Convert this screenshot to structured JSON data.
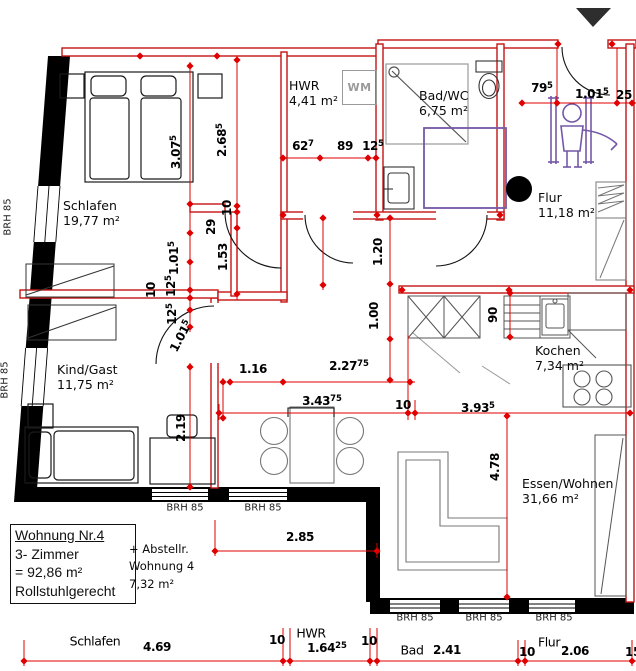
{
  "title_block": {
    "line1": "Wohnung Nr.4",
    "line2": "3- Zimmer",
    "line3": "= 92,86 m²",
    "line4": "Rollstuhlgerecht"
  },
  "annex": {
    "line1": "+ Abstellr.",
    "line2": "Wohnung 4",
    "line3": "7,32 m²"
  },
  "rooms": {
    "schlafen": {
      "name": "Schlafen",
      "area": "19,77 m²"
    },
    "hwr": {
      "name": "HWR",
      "area": "4,41 m²"
    },
    "bad": {
      "name": "Bad/WC",
      "area": "6,75 m²"
    },
    "flur": {
      "name": "Flur",
      "area": "11,18 m²"
    },
    "kind": {
      "name": "Kind/Gast",
      "area": "11,75 m²"
    },
    "kochen": {
      "name": "Kochen",
      "area": "7,34 m²"
    },
    "essen": {
      "name": "Essen/Wohnen",
      "area": "31,66 m²"
    }
  },
  "labels": {
    "wm": "WM",
    "window": "BRH 85"
  },
  "bottom_labels": {
    "schlafen": "Schlafen",
    "hwr": "HWR",
    "bad": "Bad",
    "flur": "Flur"
  },
  "dims": {
    "d307": {
      "main": "3.07",
      "sup": "5"
    },
    "d268": {
      "main": "2.68",
      "sup": "5"
    },
    "d627": {
      "main": "62",
      "sup": "7"
    },
    "d89": {
      "main": "89"
    },
    "d125": {
      "main": "12",
      "sup": "5"
    },
    "d795": {
      "main": "79",
      "sup": "5"
    },
    "d1015": {
      "main": "1.01",
      "sup": "5"
    },
    "d25": {
      "main": "25"
    },
    "d10": {
      "main": "10"
    },
    "d29": {
      "main": "29"
    },
    "d153": {
      "main": "1.53"
    },
    "d120": {
      "main": "1.20"
    },
    "d100": {
      "main": "1.00"
    },
    "d90": {
      "main": "90"
    },
    "d116": {
      "main": "1.16"
    },
    "d2275": {
      "main": "2.27",
      "sup": "75"
    },
    "d34375": {
      "main": "3.43",
      "sup": "75"
    },
    "d3935": {
      "main": "3.93",
      "sup": "5"
    },
    "d478": {
      "main": "4.78"
    },
    "d219": {
      "main": "2.19"
    },
    "d285": {
      "main": "2.85"
    },
    "d469": {
      "main": "4.69"
    },
    "d16425": {
      "main": "1.64",
      "sup": "25"
    },
    "d241": {
      "main": "2.41"
    },
    "d206": {
      "main": "2.06"
    },
    "d15": {
      "main": "15"
    }
  },
  "colors": {
    "wall_red": "#c41414",
    "dim_red": "#e00000",
    "accessible_purple": "#7458a8",
    "wall_black": "#000000"
  }
}
